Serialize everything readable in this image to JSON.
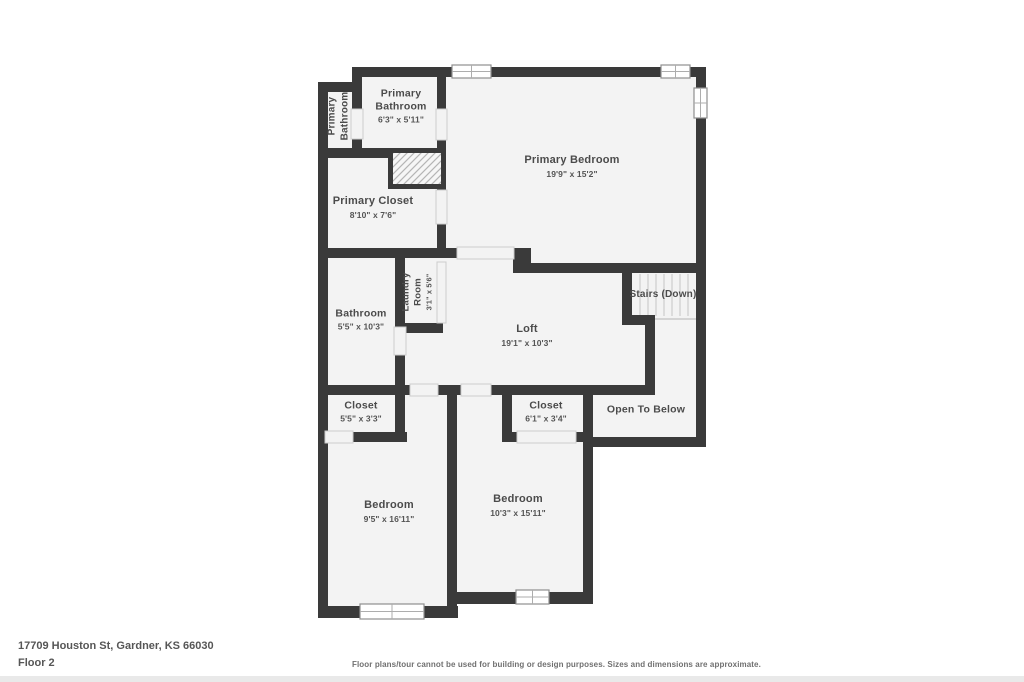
{
  "floor_plan": {
    "rooms": [
      {
        "id": "primary-bathroom-wc",
        "name": "Primary Bathroom"
      },
      {
        "id": "primary-bathroom",
        "name": "Primary Bathroom",
        "dims": "6'3\" x 5'11\""
      },
      {
        "id": "primary-closet",
        "name": "Primary Closet",
        "dims": "8'10\" x 7'6\""
      },
      {
        "id": "primary-bedroom",
        "name": "Primary Bedroom",
        "dims": "19'9\" x 15'2\""
      },
      {
        "id": "laundry-room",
        "name": "Laundry Room",
        "dims": "3'1\" x 5'6\""
      },
      {
        "id": "bathroom",
        "name": "Bathroom",
        "dims": "5'5\" x 10'3\""
      },
      {
        "id": "loft",
        "name": "Loft",
        "dims": "19'1\" x 10'3\""
      },
      {
        "id": "stairs",
        "name": "Stairs (Down)"
      },
      {
        "id": "closet-1",
        "name": "Closet",
        "dims": "5'5\" x 3'3\""
      },
      {
        "id": "closet-2",
        "name": "Closet",
        "dims": "6'1\" x 3'4\""
      },
      {
        "id": "open-to-below",
        "name": "Open To Below"
      },
      {
        "id": "bedroom-1",
        "name": "Bedroom",
        "dims": "9'5\" x 16'11\""
      },
      {
        "id": "bedroom-2",
        "name": "Bedroom",
        "dims": "10'3\" x 15'11\""
      }
    ],
    "footer": {
      "address": "17709 Houston St, Gardner, KS 66030",
      "floor_label": "Floor 2",
      "disclaimer": "Floor plans/tour cannot be used for building or design purposes. Sizes and dimensions are approximate."
    },
    "colors": {
      "wall": "#3a3a3a",
      "floor": "#f3f3f3",
      "room_label_text": "#4b4b4b",
      "window_outline": "#8f8f8f",
      "opening_line": "#c9c9c9",
      "stair_tread_line": "#c6c6c6",
      "footer_text": "#565656",
      "disclaimer_text": "#707070"
    }
  }
}
